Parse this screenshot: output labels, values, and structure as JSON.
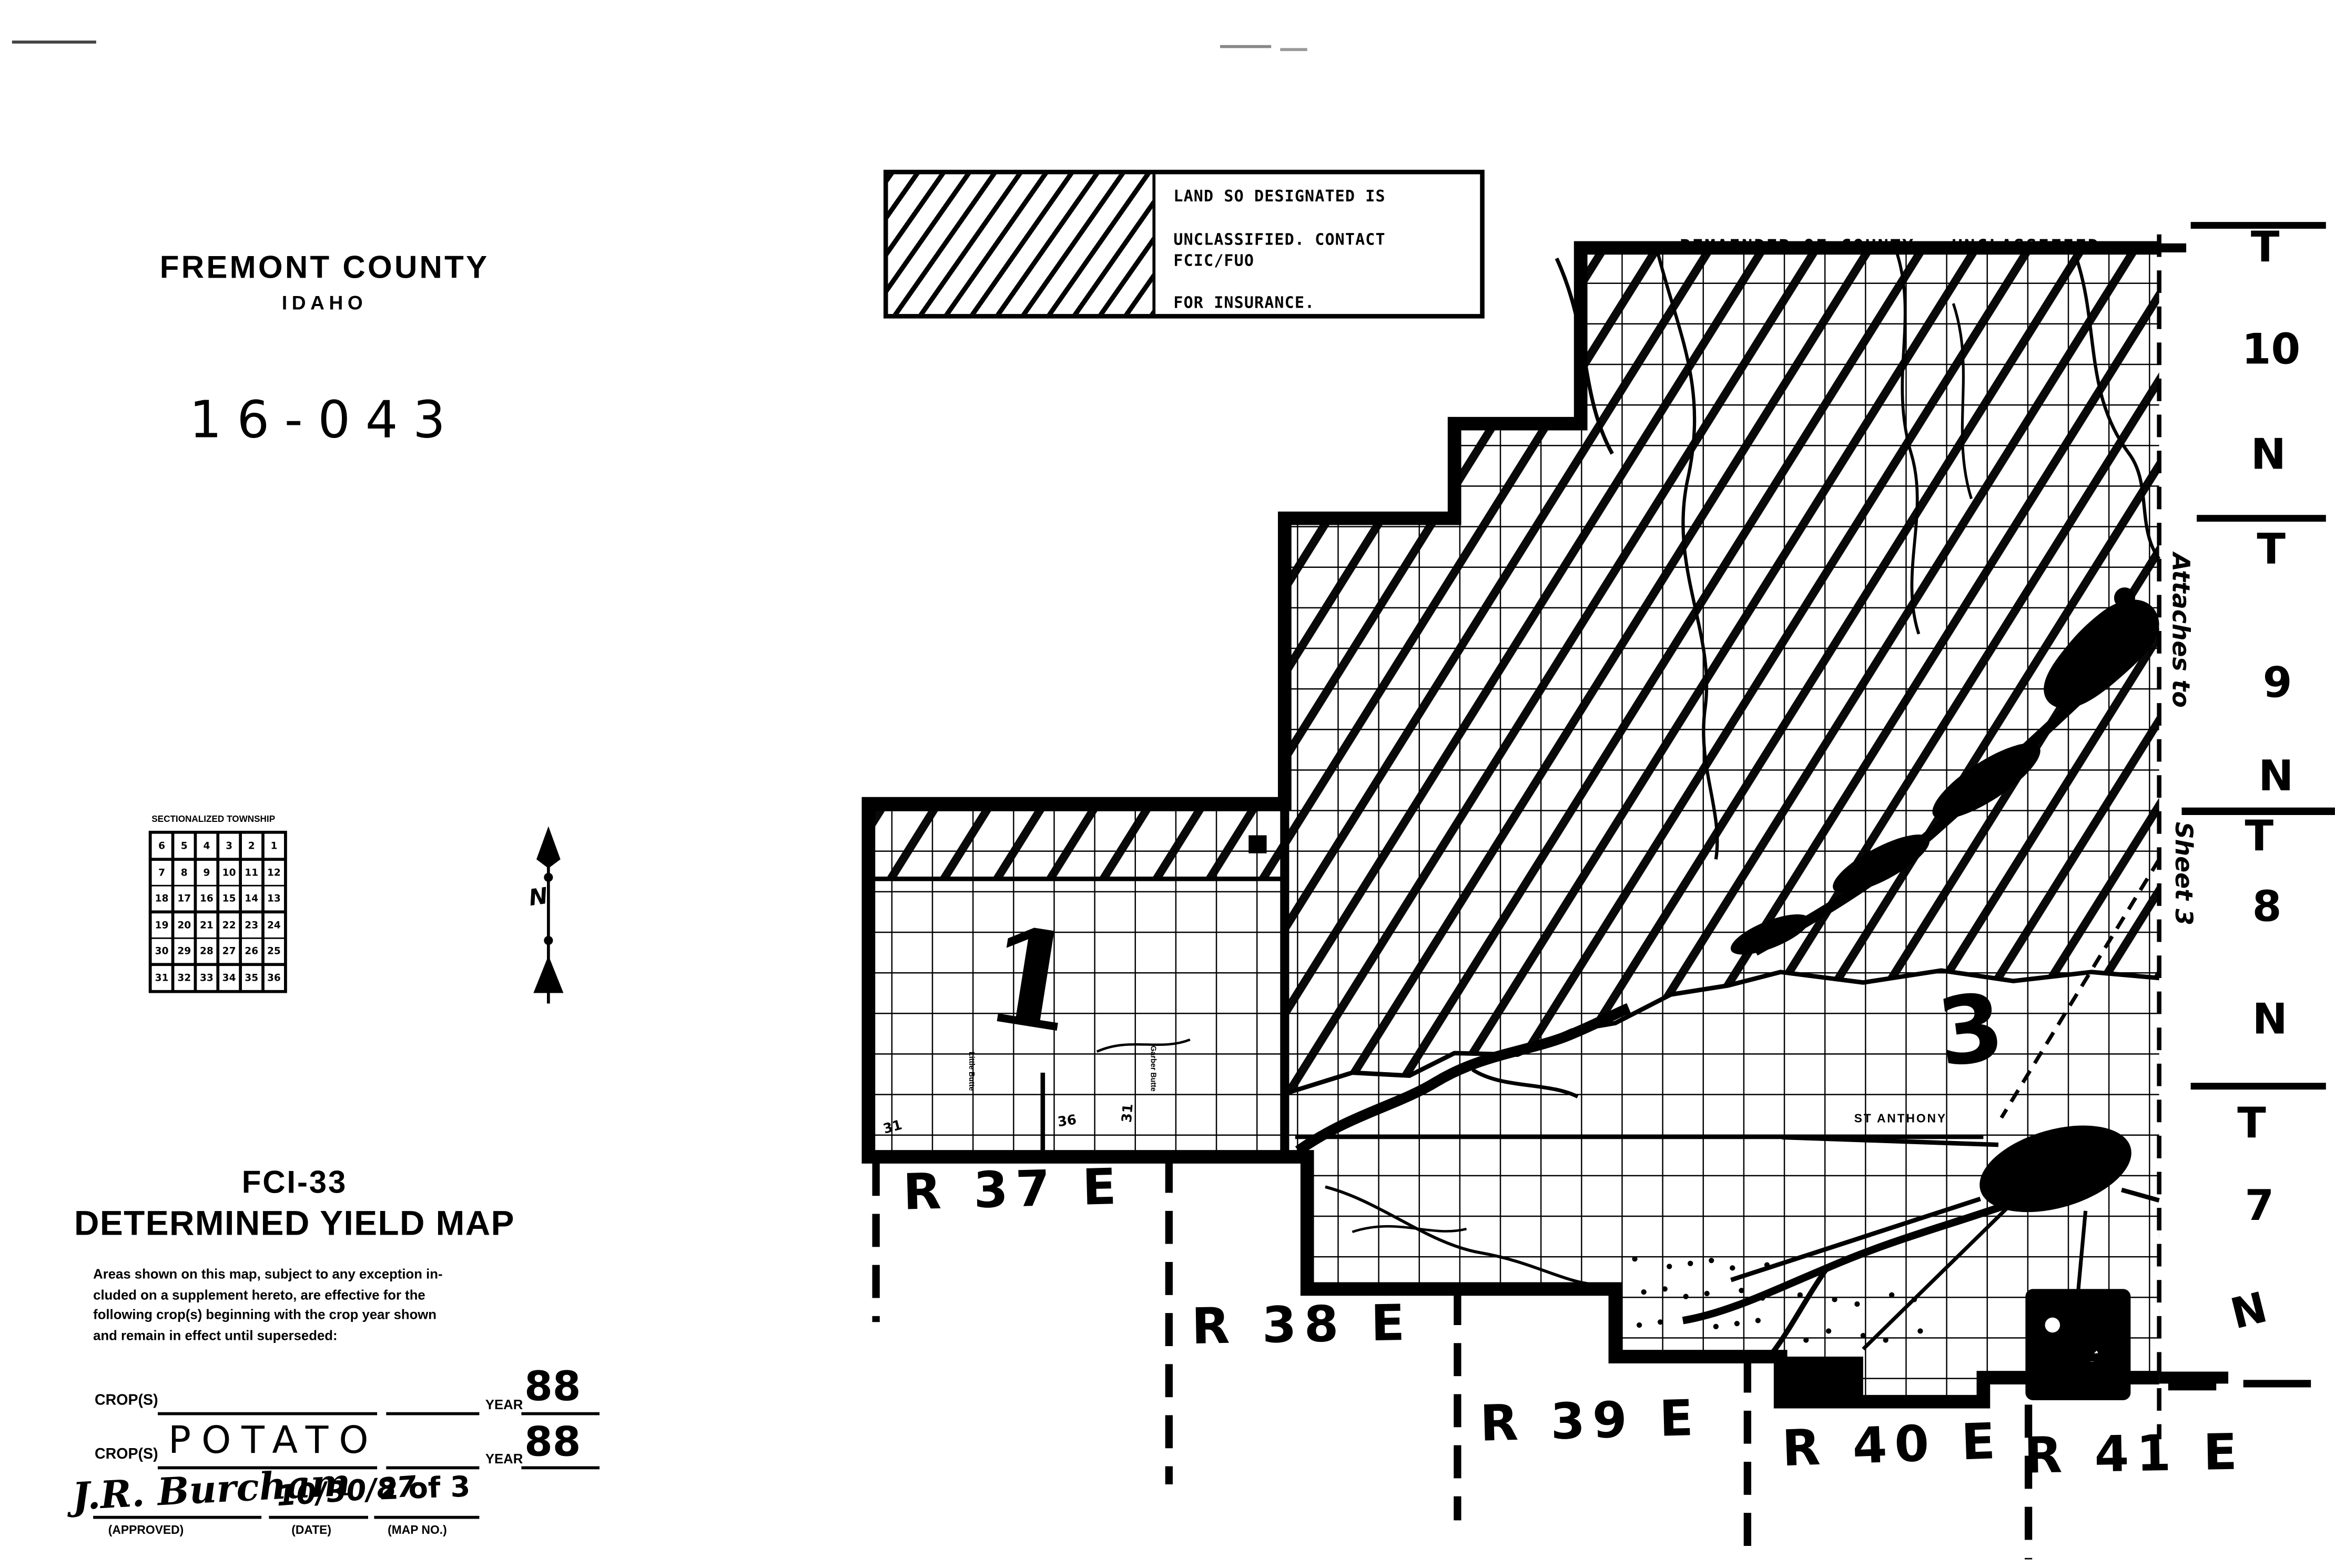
{
  "page": {
    "county_title": "FREMONT COUNTY",
    "state": "IDAHO",
    "map_code": "16-043"
  },
  "legend": {
    "lines": [
      "LAND SO DESIGNATED IS",
      "UNCLASSIFIED.  CONTACT FCIC/FUO",
      "FOR INSURANCE."
    ],
    "remainder_note": "REMAINDER OF COUNTY:  UNCLASSIFIED"
  },
  "sectionalized_township": {
    "title": "SECTIONALIZED TOWNSHIP",
    "rows": [
      [
        "6",
        "5",
        "4",
        "3",
        "2",
        "1"
      ],
      [
        "7",
        "8",
        "9",
        "10",
        "11",
        "12"
      ],
      [
        "18",
        "17",
        "16",
        "15",
        "14",
        "13"
      ],
      [
        "19",
        "20",
        "21",
        "22",
        "23",
        "24"
      ],
      [
        "30",
        "29",
        "28",
        "27",
        "26",
        "25"
      ],
      [
        "31",
        "32",
        "33",
        "34",
        "35",
        "36"
      ]
    ]
  },
  "compass": {
    "label": "N"
  },
  "map": {
    "range_labels": [
      "R 37 E",
      "R 38 E",
      "R 39 E",
      "R 40 E",
      "R 41 E"
    ],
    "townships": [
      {
        "t": "T",
        "num": "10",
        "n": "N"
      },
      {
        "t": "T",
        "num": "9",
        "n": "N"
      },
      {
        "t": "T",
        "num": "8",
        "n": "N"
      },
      {
        "t": "T",
        "num": "7",
        "n": "N"
      }
    ],
    "attachment_note": {
      "line1": "Attaches to",
      "line2": "Sheet 3"
    },
    "sheet_numbers": {
      "area1": "1",
      "area3": "3",
      "area2": "2"
    },
    "city_label": "ST ANTHONY",
    "section_numbers": [
      "31",
      "36",
      "31"
    ],
    "butte_labels": [
      "Little Butte",
      "Garber Butte"
    ]
  },
  "footer": {
    "form_code": "FCI-33",
    "map_title": "DETERMINED YIELD MAP",
    "note_lines": [
      "Areas shown on this map, subject to any exception in-",
      "cluded on a supplement hereto,  are  effective for the",
      "following crop(s)  beginning with the crop year shown",
      "and remain in effect until superseded:"
    ],
    "crop_rows": [
      {
        "label": "CROP(S)",
        "value": "",
        "year_label": "YEAR",
        "year": "88"
      },
      {
        "label": "CROP(S)",
        "value": "POTATO",
        "year_label": "YEAR",
        "year": "88"
      }
    ],
    "approval": {
      "signature": "J.R. Burcham",
      "date": "10/30/87",
      "map_no": "2 of 3",
      "approved_label": "(APPROVED)",
      "date_label": "(DATE)",
      "map_no_label": "(MAP NO.)"
    }
  }
}
